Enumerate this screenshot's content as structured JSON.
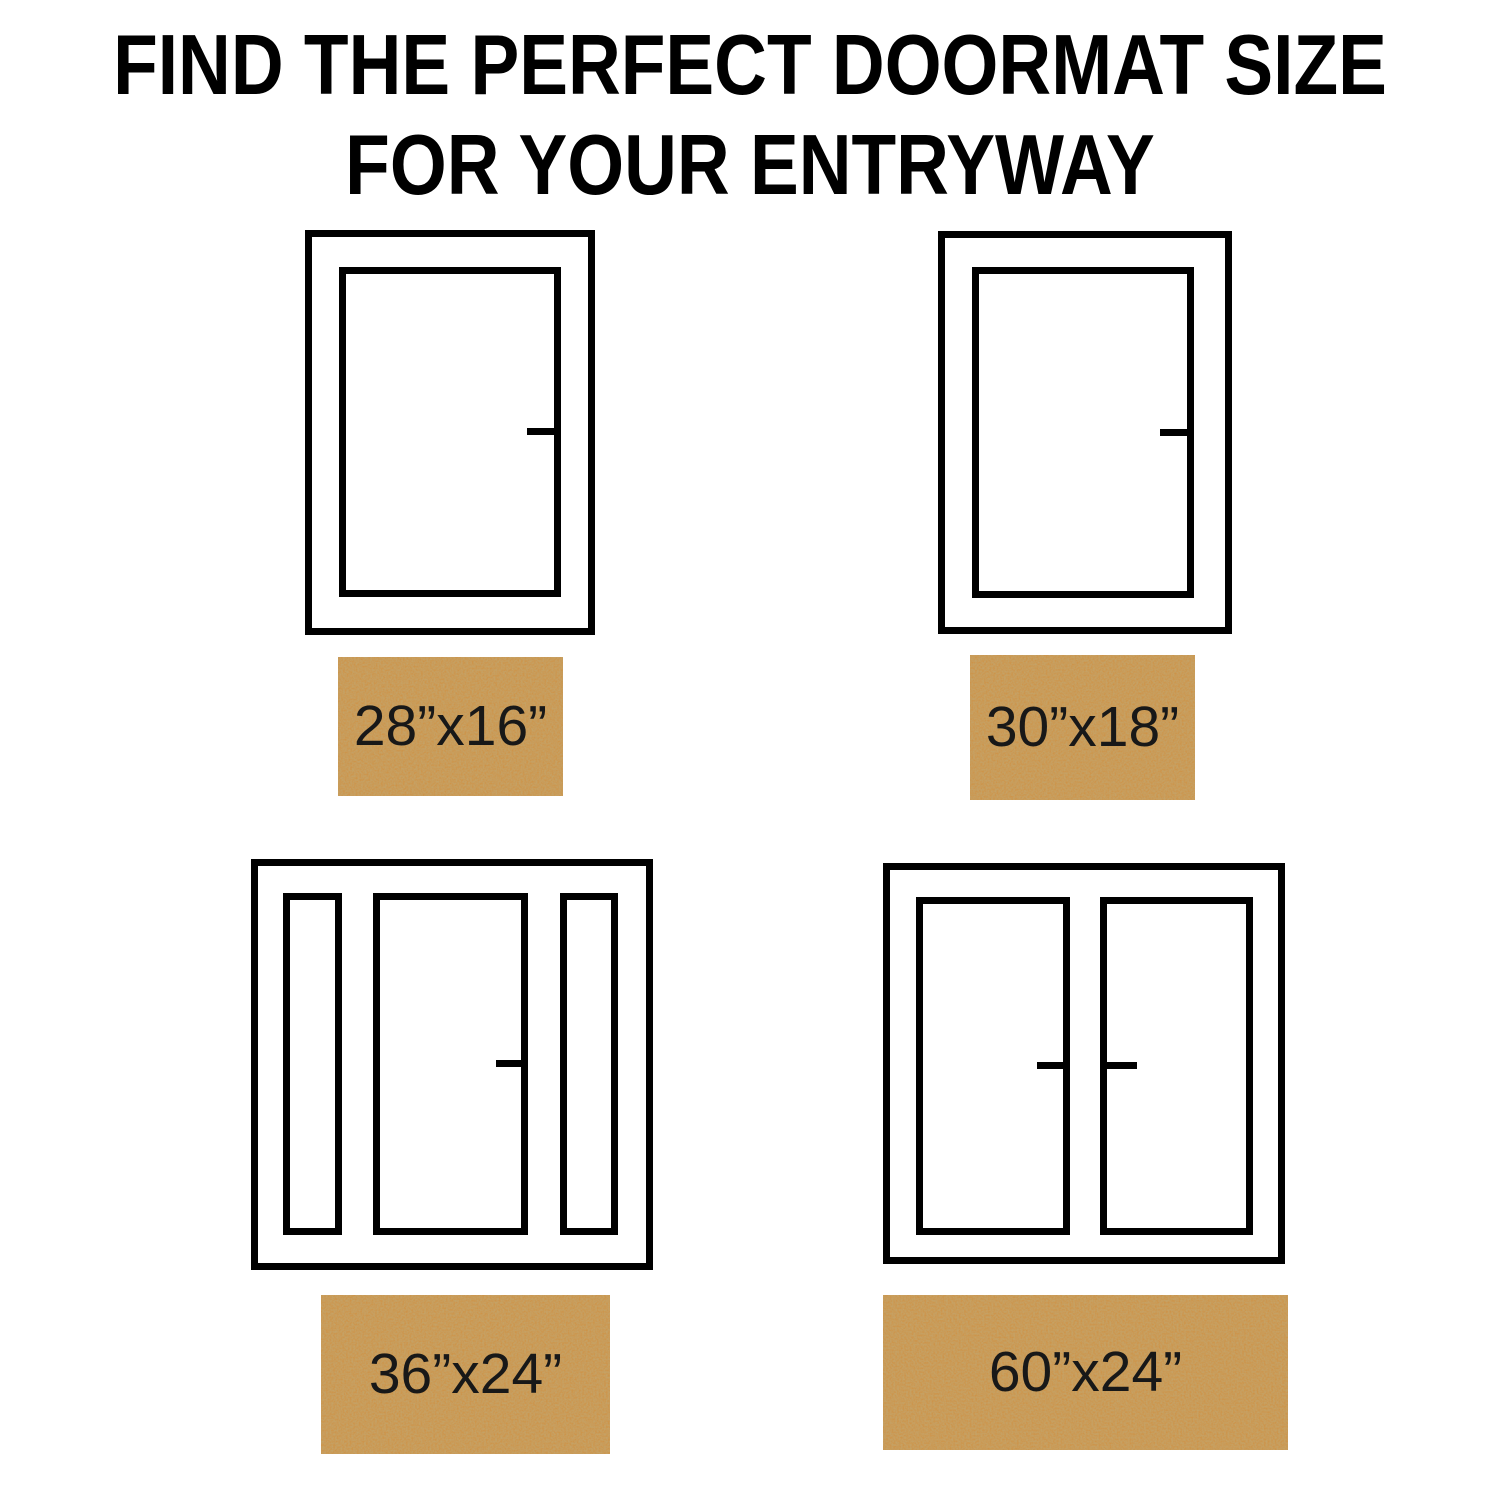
{
  "title": {
    "line1": "FIND THE PERFECT DOORMAT SIZE",
    "line2": "FOR YOUR ENTRYWAY"
  },
  "mats": [
    {
      "label": "28”x16”"
    },
    {
      "label": "30”x18”"
    },
    {
      "label": "36”x24”"
    },
    {
      "label": "60”x24”"
    }
  ],
  "colors": {
    "outline": "#000000",
    "background": "#ffffff",
    "mat_base": "#cd9449",
    "mat_speckle": "#8f5c22",
    "mat_label_text": "#181818",
    "title_text": "#000000"
  }
}
